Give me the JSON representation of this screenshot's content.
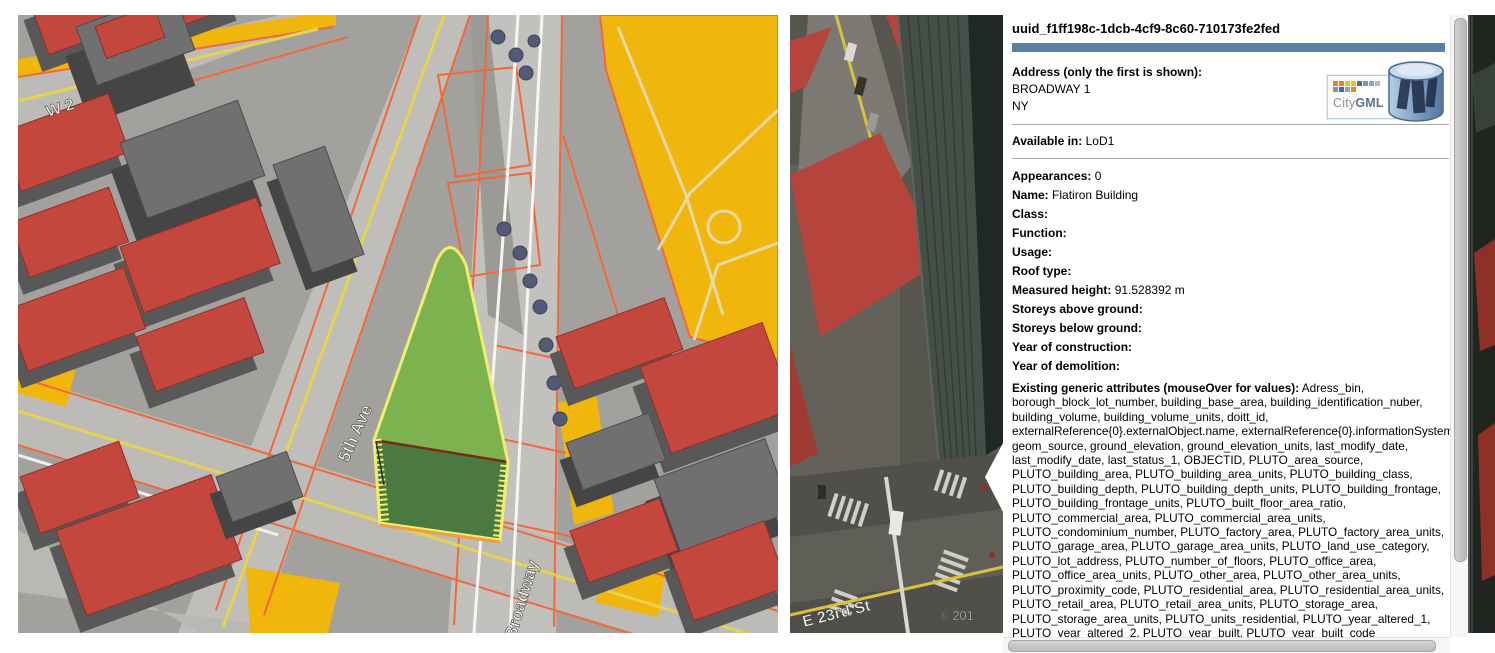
{
  "left_map": {
    "labels": {
      "w2": "W 2",
      "fifth_ave": "5th Ave",
      "broadway": "Broadway"
    },
    "highlight_building": "Flatiron Building footprint (selected, LoD1 highlight)"
  },
  "right_map": {
    "street": "E 23rd St",
    "copyright": "© 201"
  },
  "info_panel": {
    "title": "uuid_f1ff198c-1dcb-4cf9-8c60-710173fe2fed",
    "address_label": "Address (only the first is shown):",
    "address_line1": "BROADWAY 1",
    "address_line2": "NY",
    "available_label": "Available in:",
    "available_value": "LoD1",
    "fields": [
      {
        "label": "Appearances:",
        "value": "0"
      },
      {
        "label": "Name:",
        "value": "Flatiron Building"
      },
      {
        "label": "Class:",
        "value": ""
      },
      {
        "label": "Function:",
        "value": ""
      },
      {
        "label": "Usage:",
        "value": ""
      },
      {
        "label": "Roof type:",
        "value": ""
      },
      {
        "label": "Measured height:",
        "value": "91.528392 m"
      },
      {
        "label": "Storeys above ground:",
        "value": ""
      },
      {
        "label": "Storeys below ground:",
        "value": ""
      },
      {
        "label": "Year of construction:",
        "value": ""
      },
      {
        "label": "Year of demolition:",
        "value": ""
      }
    ],
    "generic_attributes_label": "Existing generic attributes (mouseOver for values):",
    "generic_attributes_value": "Adress_bin, borough_block_lot_number, building_base_area, building_identification_nuber, building_volume, building_volume_units, doitt_id, externalReference{0}.externalObject.name, externalReference{0}.informationSystem, geom_source, ground_elevation, ground_elevation_units, last_modify_date, last_modify_date, last_status_1, OBJECTID, PLUTO_area_source, PLUTO_building_area, PLUTO_building_area_units, PLUTO_building_class, PLUTO_building_depth, PLUTO_building_depth_units, PLUTO_building_frontage, PLUTO_building_frontage_units, PLUTO_built_floor_area_ratio, PLUTO_commercial_area, PLUTO_commercial_area_units, PLUTO_condominium_number, PLUTO_factory_area, PLUTO_factory_area_units, PLUTO_garage_area, PLUTO_garage_area_units, PLUTO_land_use_category, PLUTO_lot_address, PLUTO_number_of_floors, PLUTO_office_area, PLUTO_office_area_units, PLUTO_other_area, PLUTO_other_area_units, PLUTO_proximity_code, PLUTO_residential_area, PLUTO_residential_area_units, PLUTO_retail_area, PLUTO_retail_area_units, PLUTO_storage_area, PLUTO_storage_area_units, PLUTO_units_residential, PLUTO_year_altered_1, PLUTO_year_altered_2, PLUTO_year_built, PLUTO_year_built_code",
    "external_references_label": "External references (mouseOver for InformationSystem):",
    "external_references_value": "AddressPoint_[13.10.2014]_ADDRESSID_1019868,",
    "logo": {
      "city": "City",
      "gml": "GML"
    }
  },
  "colors": {
    "title_bar_blue": "#5b80a5",
    "roof_red": "#c4473e",
    "wall_gray": "#5a5a5a",
    "parcel_orange": "#f0b60c",
    "lot_line_orange": "#f2683a",
    "highlight_roof_green": "#7db34f",
    "highlight_wall_green": "#4b7a41",
    "highlight_outline_yellow": "#f0ee70"
  }
}
